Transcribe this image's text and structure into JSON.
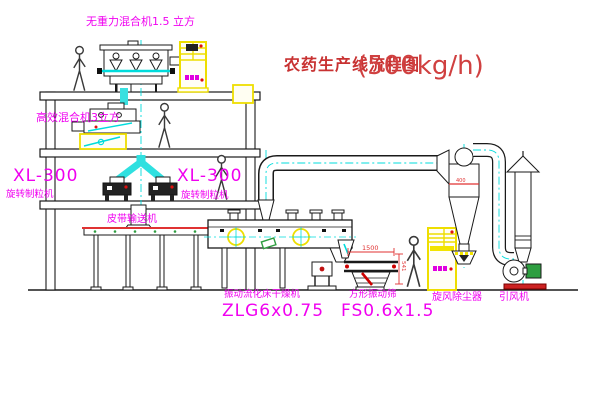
{
  "title": {
    "text": "农药生产线流程图",
    "capacity": "(500kg/h)"
  },
  "equipment_labels": {
    "gravity_free_mixer": "无重力混合机1.5 立方",
    "high_efficiency_mixer": "高效混合机3立方",
    "granulator_left_model": "XL-300",
    "granulator_left_name": "旋转制粒机",
    "granulator_right_model": "XL-300",
    "granulator_right_name": "旋转制粒机",
    "belt_conveyor": "皮带输送机",
    "fluid_bed_dryer_name": "振动流化床干燥机",
    "fluid_bed_dryer_model": "ZLG6x0.75",
    "square_sieve_name": "方形振动筛",
    "square_sieve_model": "FS0.6x1.5",
    "cyclone_collector": "旋风除尘器",
    "induced_draft_fan": "引风机"
  },
  "dimensions": {
    "sieve_length": "1500",
    "sieve_height": "541",
    "cyclone_note": "400"
  },
  "colors": {
    "label_magenta": "#f000f0",
    "title_red": "#c83232",
    "dimension_red": "#e03232",
    "pipe_cyan": "#00dcdc",
    "equipment_yellow": "#eede00",
    "accent_green": "#2e9e40",
    "line_black": "#1a1a1a"
  }
}
